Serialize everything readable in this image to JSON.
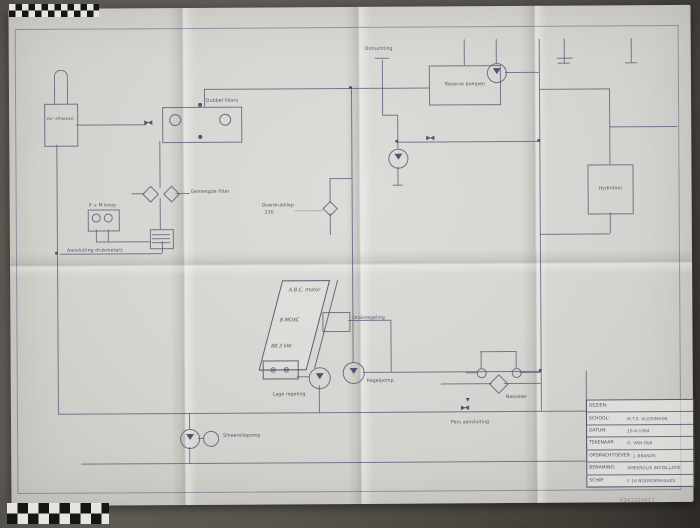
{
  "photo": {
    "archive_id": "0341200617"
  },
  "diagram": {
    "labels": {
      "vent_top": "Ontluchting",
      "tank": "Vul- aftapkast",
      "dual_filters": "Dubbel filters",
      "mixed_filter": "Gemengde filter",
      "gauge_panel": "P + M knop",
      "gauge_connection": "Aansluiting drukmeters",
      "relief_valve_line1": "Overdrukklep",
      "relief_valve_line2": "230",
      "engine_line1": "A.B.C. motor",
      "engine_line2": "8 MDXC",
      "engine_line3": "88.3 kW",
      "pulley_symbols": "⊗ ⊗",
      "drain_control": "Drainregeling",
      "low_control": "Lage regeling",
      "control_pump": "Regelpomp",
      "reserve_pumps": "Reserve pompen",
      "hydrophore": "Hydrofoor",
      "aftercooler": "Nakoeler",
      "thermo_valve": "Pers aansluiting",
      "lube_pump": "Smeeroliepomp"
    }
  },
  "title_block": {
    "rows": [
      {
        "label": "GEZIEN:",
        "value": ""
      },
      {
        "label": "SCHOOL:",
        "value": "M.T.S. VLISSINGEN"
      },
      {
        "label": "DATUM:",
        "value": "10-4-1984"
      },
      {
        "label": "TEKENAAR:",
        "value": "G. VAN DIJK"
      },
      {
        "label": "OPDRACHTGEVER:",
        "value": "J. BRANDS"
      },
      {
        "label": "BENAMING:",
        "value": "SMEEROLIE INSTALLATIE"
      },
      {
        "label": "SCHIP:",
        "value": "F 16 NOORDERHAAKS"
      }
    ]
  }
}
